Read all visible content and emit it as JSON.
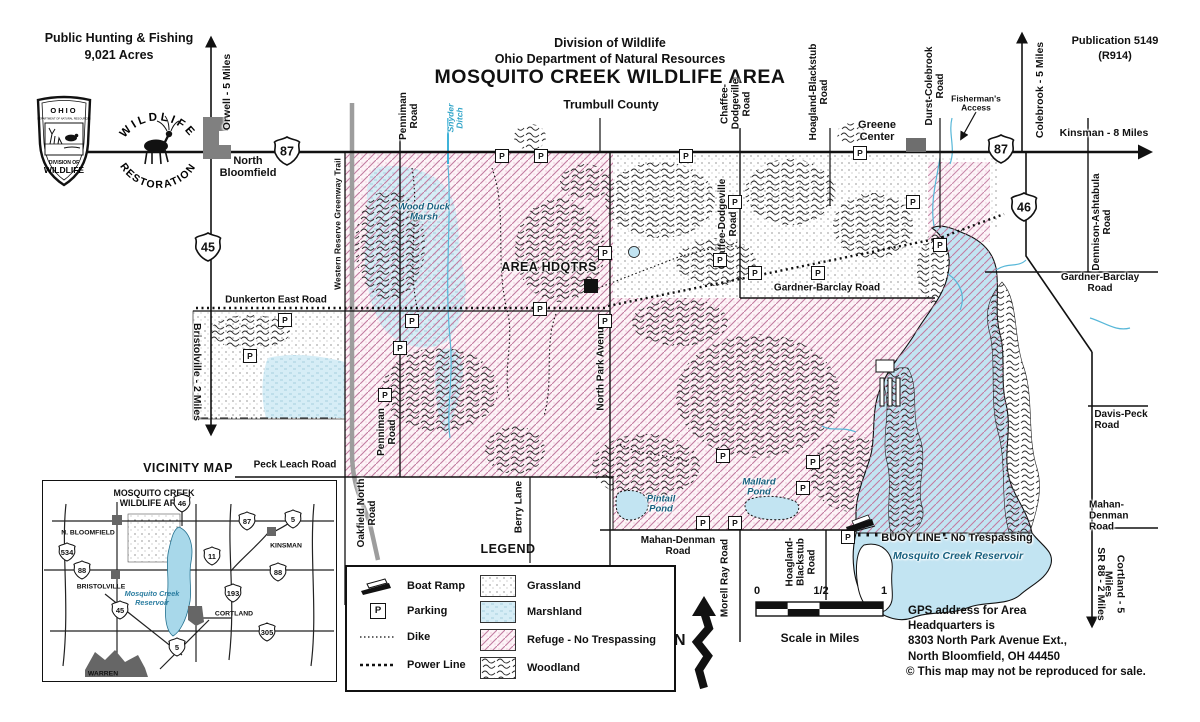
{
  "header": {
    "public_hunting": "Public Hunting & Fishing\n9,021 Acres",
    "division": "Division of Wildlife",
    "department": "Ohio Department of Natural Resources",
    "title": "MOSQUITO CREEK WILDLIFE AREA",
    "publication": "Publication 5149\n(R914)",
    "logo_ohio": {
      "state": "OHIO",
      "dept": "DEPARTMENT OF NATURAL RESOURCES",
      "div1": "DIVISION OF",
      "div2": "WILDLIFE"
    },
    "logo_restoration": {
      "top": "WILDLIFE",
      "bottom": "RESTORATION"
    }
  },
  "map": {
    "parking_letter": "P",
    "labels": [
      {
        "t": "Orwell - 5 Miles",
        "x": 228,
        "y": 92,
        "r": -90,
        "cls": "dir"
      },
      {
        "t": "Colebrook - 5 Miles",
        "x": 1041,
        "y": 90,
        "r": -90,
        "cls": "dir"
      },
      {
        "t": "Kinsman - 8 Miles",
        "x": 1104,
        "y": 134,
        "cls": "dir"
      },
      {
        "t": "Bristolville - 2 Miles",
        "x": 196,
        "y": 372,
        "r": 90,
        "cls": "dir"
      },
      {
        "t": "SR 88 - 2 Miles",
        "x": 1100,
        "y": 584,
        "r": 90,
        "cls": "dir"
      },
      {
        "t": "Cortland - 5 Miles",
        "x": 1114,
        "y": 584,
        "r": 90,
        "cls": "dir"
      },
      {
        "t": "Penniman\nRoad",
        "x": 409,
        "y": 116,
        "r": -90
      },
      {
        "t": "Snyder\nDitch",
        "x": 456,
        "y": 118,
        "r": -90,
        "cls": "water-sm"
      },
      {
        "t": "Chaffee-\nDodgeville\nRoad",
        "x": 736,
        "y": 104,
        "r": -90
      },
      {
        "t": "Hoagland-Blackstub\nRoad",
        "x": 819,
        "y": 92,
        "r": -90
      },
      {
        "t": "Durst-Colebrook\nRoad",
        "x": 935,
        "y": 86,
        "r": -90
      },
      {
        "t": "Dennison-Ashtabula\nRoad",
        "x": 1102,
        "y": 222,
        "r": -90
      },
      {
        "t": "Gardner-Barclay Road",
        "x": 827,
        "y": 288
      },
      {
        "t": "Gardner-Barclay Road",
        "x": 1100,
        "y": 283
      },
      {
        "t": "Davis-Peck\nRoad",
        "x": 1121,
        "y": 420,
        "cls": "al"
      },
      {
        "t": "Mahan-Denman\nRoad",
        "x": 1126,
        "y": 516,
        "cls": "al"
      },
      {
        "t": "Mahan-Denman\nRoad",
        "x": 678,
        "y": 546
      },
      {
        "t": "Dunkerton East Road",
        "x": 276,
        "y": 300
      },
      {
        "t": "Peck Leach Road",
        "x": 295,
        "y": 465
      },
      {
        "t": "Oakfield North\nRoad",
        "x": 367,
        "y": 513,
        "r": -90
      },
      {
        "t": "Berry Lane",
        "x": 519,
        "y": 507,
        "r": -90
      },
      {
        "t": "North Park Avenue",
        "x": 601,
        "y": 366,
        "r": -90
      },
      {
        "t": "Morell Ray Road",
        "x": 725,
        "y": 578,
        "r": -90
      },
      {
        "t": "Hoagland-\nBlackstub\nRoad",
        "x": 801,
        "y": 562,
        "r": -90
      },
      {
        "t": "Penniman\nRoad",
        "x": 387,
        "y": 432,
        "r": -90
      },
      {
        "t": "Chaffee-Dodgeville\nRoad",
        "x": 728,
        "y": 224,
        "r": -90
      },
      {
        "t": "Western Reserve Greenway Trail",
        "x": 338,
        "y": 224,
        "r": -90,
        "cls": "road-sm"
      },
      {
        "t": "Trumbull County",
        "x": 611,
        "y": 105,
        "cls": "county"
      },
      {
        "t": "Greene\nCenter",
        "x": 877,
        "y": 131,
        "cls": "town"
      },
      {
        "t": "North\nBloomfield",
        "x": 248,
        "y": 167,
        "cls": "town"
      },
      {
        "t": "Fisherman's\nAccess",
        "x": 976,
        "y": 104,
        "cls": "small"
      },
      {
        "t": "AREA HDQTRS",
        "x": 549,
        "y": 268,
        "cls": "poi"
      },
      {
        "t": "Wood Duck\nMarsh",
        "x": 424,
        "y": 213,
        "cls": "water"
      },
      {
        "t": "Pintail\nPond",
        "x": 661,
        "y": 505,
        "cls": "water"
      },
      {
        "t": "Mallard\nPond",
        "x": 759,
        "y": 488,
        "cls": "water"
      },
      {
        "t": "BUOY LINE - No Trespassing",
        "x": 957,
        "y": 538,
        "cls": "buoy"
      },
      {
        "t": "Mosquito Creek Reservoir",
        "x": 958,
        "y": 557,
        "cls": "water-lg"
      }
    ],
    "shields": [
      {
        "num": "87",
        "x": 287,
        "y": 151
      },
      {
        "num": "87",
        "x": 1001,
        "y": 149
      },
      {
        "num": "46",
        "x": 1024,
        "y": 207
      },
      {
        "num": "45",
        "x": 208,
        "y": 247
      }
    ],
    "parking": [
      [
        502,
        156
      ],
      [
        541,
        156
      ],
      [
        686,
        156
      ],
      [
        860,
        153
      ],
      [
        913,
        202
      ],
      [
        735,
        202
      ],
      [
        605,
        253
      ],
      [
        720,
        260
      ],
      [
        755,
        273
      ],
      [
        818,
        273
      ],
      [
        540,
        309
      ],
      [
        412,
        321
      ],
      [
        285,
        320
      ],
      [
        250,
        356
      ],
      [
        400,
        348
      ],
      [
        385,
        395
      ],
      [
        605,
        321
      ],
      [
        723,
        456
      ],
      [
        813,
        462
      ],
      [
        803,
        488
      ],
      [
        703,
        523
      ],
      [
        735,
        523
      ],
      [
        848,
        537
      ],
      [
        940,
        245
      ]
    ]
  },
  "vicinity": {
    "title": "VICINITY MAP",
    "area_label": "MOSQUITO CREEK\nWILDLIFE AREA",
    "reservoir_label": "Mosquito Creek\nReservoir",
    "towns": [
      {
        "name": "N. BLOOMFIELD",
        "x": 88,
        "y": 533
      },
      {
        "name": "KINSMAN",
        "x": 286,
        "y": 546
      },
      {
        "name": "BRISTOLVILLE",
        "x": 101,
        "y": 587
      },
      {
        "name": "CORTLAND",
        "x": 234,
        "y": 614
      },
      {
        "name": "WARREN",
        "x": 103,
        "y": 674
      }
    ],
    "shields": [
      {
        "num": "46",
        "x": 182,
        "y": 503
      },
      {
        "num": "87",
        "x": 247,
        "y": 521
      },
      {
        "num": "5",
        "x": 293,
        "y": 519
      },
      {
        "num": "534",
        "x": 67,
        "y": 552
      },
      {
        "num": "88",
        "x": 82,
        "y": 570
      },
      {
        "num": "11",
        "x": 212,
        "y": 556
      },
      {
        "num": "88",
        "x": 278,
        "y": 572
      },
      {
        "num": "193",
        "x": 233,
        "y": 593
      },
      {
        "num": "45",
        "x": 120,
        "y": 610
      },
      {
        "num": "305",
        "x": 267,
        "y": 632
      },
      {
        "num": "5",
        "x": 177,
        "y": 647
      }
    ]
  },
  "legend": {
    "title": "LEGEND",
    "symbols": [
      {
        "label": "Boat Ramp",
        "icon": "boat-ramp-icon"
      },
      {
        "label": "Parking",
        "icon": "parking-icon"
      },
      {
        "label": "Dike",
        "icon": "dike-icon"
      },
      {
        "label": "Power Line",
        "icon": "power-line-icon"
      }
    ],
    "areas": [
      {
        "label": "Grassland",
        "swatch": "grassland"
      },
      {
        "label": "Marshland",
        "swatch": "marshland"
      },
      {
        "label": "Refuge - No Trespassing",
        "swatch": "refuge"
      },
      {
        "label": "Woodland",
        "swatch": "woodland"
      }
    ]
  },
  "compass": {
    "north_letter": "N"
  },
  "scale": {
    "ticks": [
      "0",
      "1/2",
      "1"
    ],
    "caption": "Scale in Miles"
  },
  "footer": {
    "gps": "GPS address for Area\nHeadquarters is\n8303 North Park Avenue Ext.,\nNorth Bloomfield, OH 44450",
    "copyright": "© This map may not be reproduced for sale."
  },
  "colors": {
    "refuge_line": "#c27ba0",
    "refuge_bg": "#fdf3f7",
    "marsh": "#d6edf6",
    "water": "#c2e4f2",
    "trail_gray": "#9d9d9d",
    "woodland_ink": "#2e2e2e"
  }
}
